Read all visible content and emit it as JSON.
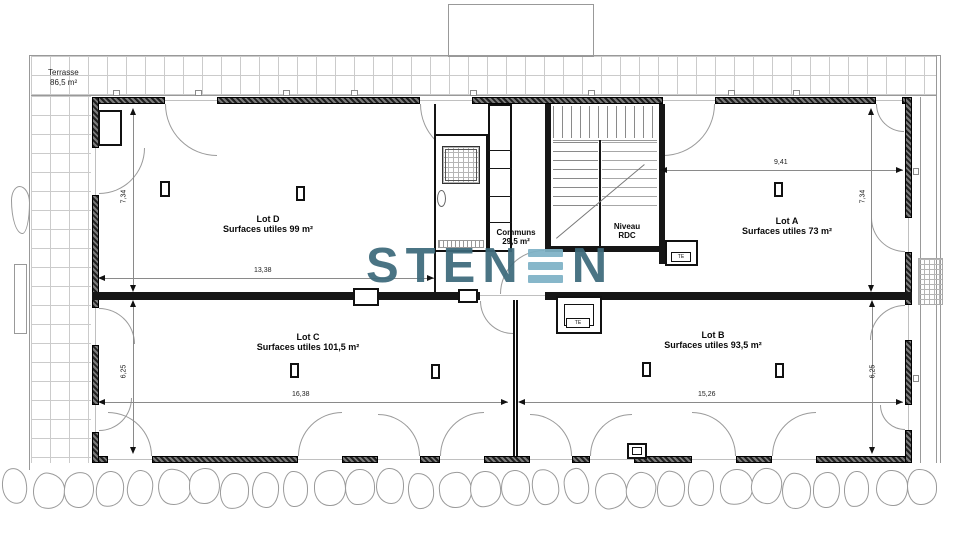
{
  "terrace": {
    "label": "Terrasse",
    "area": "86,5 m²"
  },
  "lots": {
    "d": {
      "name": "Lot D",
      "area": "Surfaces utiles 99 m²",
      "width": "13,38",
      "height": "7,34"
    },
    "a": {
      "name": "Lot A",
      "area": "Surfaces utiles 73 m²",
      "width": "9,41",
      "height": "7,34"
    },
    "c": {
      "name": "Lot C",
      "area": "Surfaces utiles 101,5 m²",
      "width": "16,38",
      "height": "6,25"
    },
    "b": {
      "name": "Lot B",
      "area": "Surfaces utiles 93,5 m²",
      "width": "15,26",
      "height": "6,25"
    }
  },
  "communs": {
    "name": "Communs",
    "area": "29,5 m²"
  },
  "level": {
    "line1": "Niveau",
    "line2": "RDC"
  },
  "annotations": {
    "te": "TE"
  },
  "logo": {
    "text_dark_left": "STEN",
    "text_dark_right": "N",
    "stylized_letter": "E",
    "dark_color": "#3d6a7b",
    "light_color": "#7eb2c6"
  }
}
